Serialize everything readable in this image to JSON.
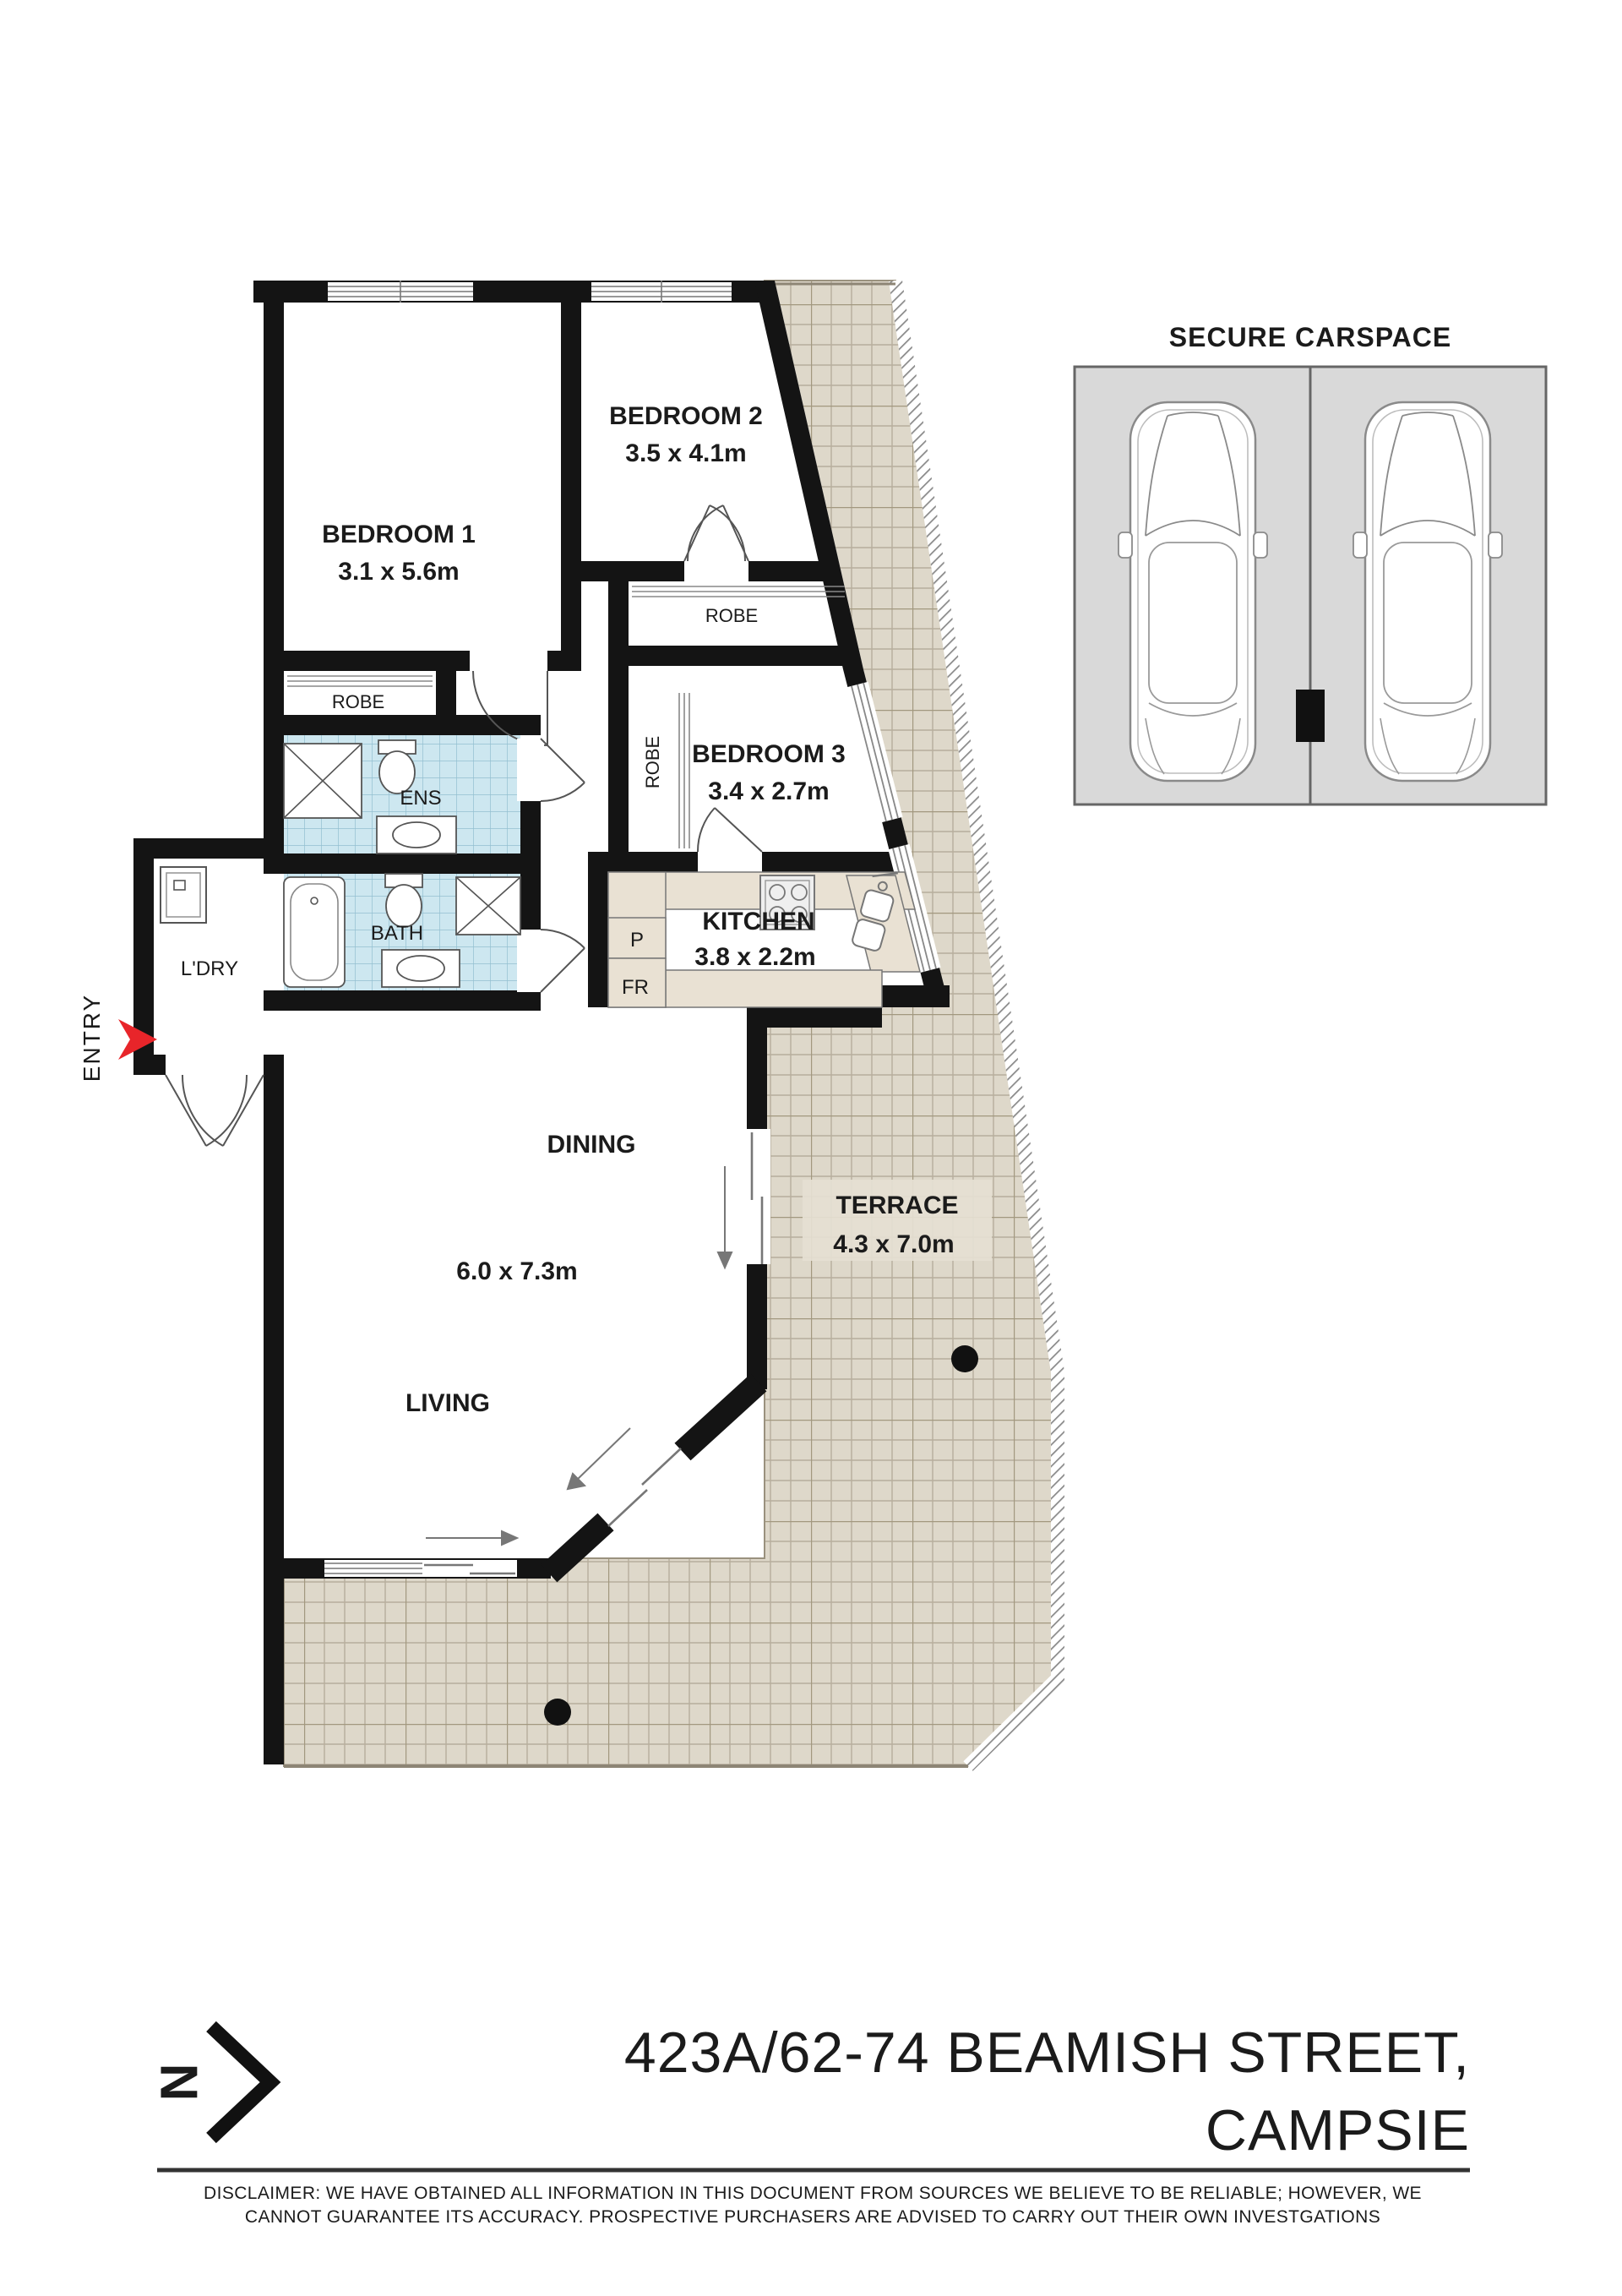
{
  "colors": {
    "wall": "#141414",
    "terrace_tile_bg": "#ded8ca",
    "terrace_tile_grid": "#b7ae9c",
    "blue_tile_bg": "#cde7f0",
    "blue_tile_grid": "#93bfd0",
    "bench": "#e9e1d3",
    "carspace_bg": "#d9d9d9",
    "accent_red": "#e8252a"
  },
  "plan": {
    "entry_label": "ENTRY",
    "rooms": {
      "bedroom1": {
        "name": "BEDROOM 1",
        "dims": "3.1 x 5.6m"
      },
      "bedroom2": {
        "name": "BEDROOM 2",
        "dims": "3.5 x 4.1m"
      },
      "bedroom3": {
        "name": "BEDROOM 3",
        "dims": "3.4 x 2.7m"
      },
      "kitchen": {
        "name": "KITCHEN",
        "dims": "3.8 x 2.2m"
      },
      "dining": {
        "name": "DINING"
      },
      "living": {
        "name": "LIVING"
      },
      "living_dining_dims": "6.0 x 7.3m",
      "terrace": {
        "name": "TERRACE",
        "dims": "4.3 x 7.0m"
      },
      "ensuite": {
        "name": "ENS"
      },
      "bathroom": {
        "name": "BATH"
      },
      "laundry": {
        "name": "L'DRY"
      },
      "robe_bed1": {
        "name": "ROBE"
      },
      "robe_bed2": {
        "name": "ROBE"
      },
      "robe_bed3": {
        "name": "ROBE"
      },
      "pantry": {
        "name": "P"
      },
      "fridge": {
        "name": "FR"
      }
    }
  },
  "carspace": {
    "title": "SECURE CARSPACE"
  },
  "compass": {
    "north_letter": "N"
  },
  "footer": {
    "address_line1": "423A/62-74 BEAMISH STREET,",
    "address_line2": "CAMPSIE",
    "disclaimer_line1": "DISCLAIMER: WE HAVE OBTAINED ALL INFORMATION IN THIS DOCUMENT FROM SOURCES WE BELIEVE TO BE RELIABLE; HOWEVER, WE",
    "disclaimer_line2": "CANNOT GUARANTEE ITS ACCURACY. PROSPECTIVE PURCHASERS ARE ADVISED TO CARRY OUT THEIR OWN INVESTGATIONS"
  }
}
